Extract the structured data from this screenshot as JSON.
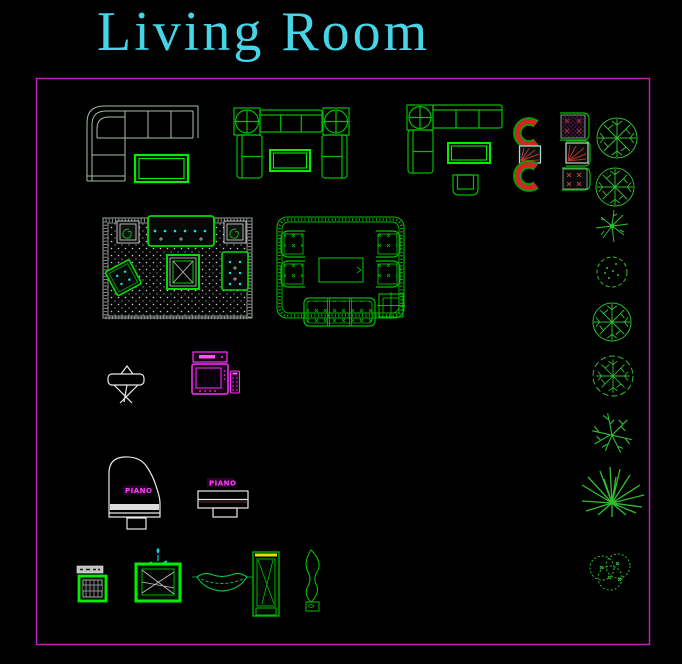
{
  "title": "Living Room",
  "labels": {
    "grand_piano": "PIANO",
    "upright_piano": "PIANO"
  },
  "colors": {
    "background": "#000000",
    "title_text": "#46D4E6",
    "frame": "#BB22BB",
    "furniture_green": "#00BE00",
    "bright_green": "#00EE00",
    "dim_gray_green": "#A8BCA8",
    "magenta": "#FF2FFF",
    "cyan": "#00D8EE",
    "red": "#D22525",
    "white": "#E8E8E8",
    "yellow": "#E0E000"
  },
  "blocks": [
    "sectional-sofa",
    "u-sofa-set",
    "l-sofa-set",
    "coffee-table",
    "barrel-chairs",
    "accent-chairs",
    "rug-sofa-set-dotted",
    "rug-sofa-set-tufted",
    "folding-chair",
    "tv-with-vcr-and-remote",
    "grand-piano",
    "upright-piano",
    "radio-cabinet",
    "tv-cabinet-with-lamp",
    "hammock",
    "tall-cabinet",
    "candle-sculpture",
    "round-tree",
    "star-plant",
    "scalloped-tree",
    "leafy-tree",
    "branch-tree",
    "spiky-plant",
    "bush"
  ]
}
